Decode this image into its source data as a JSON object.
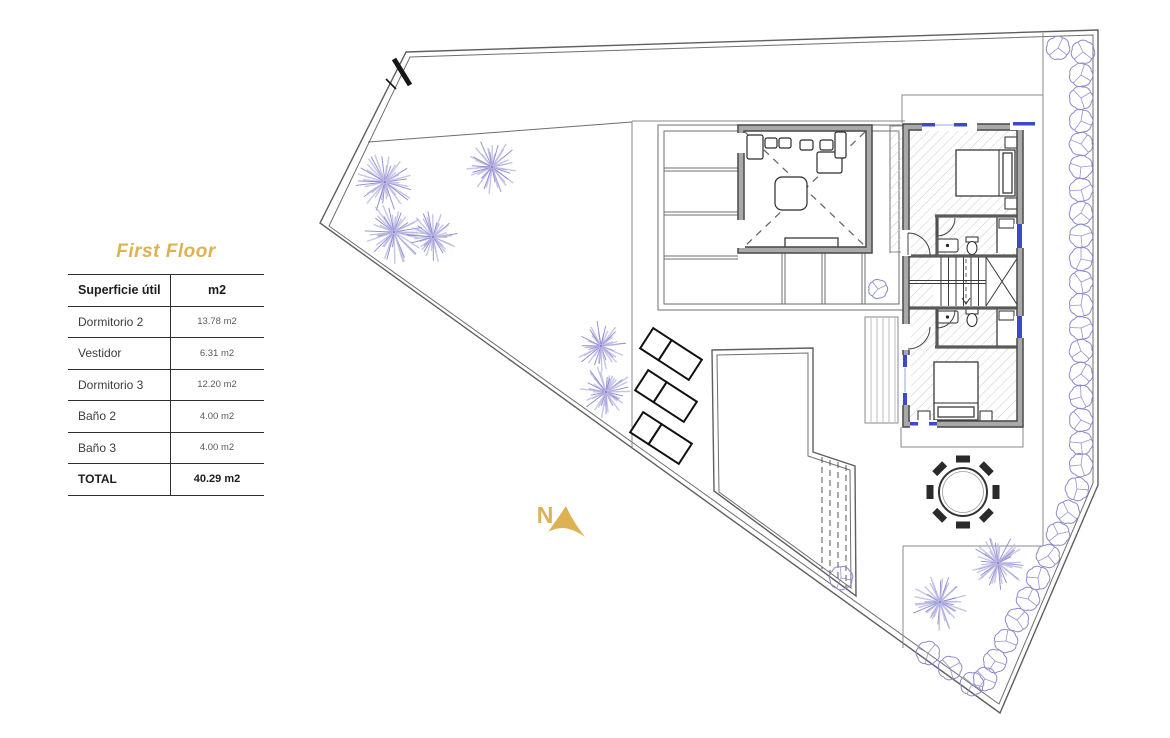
{
  "page_title": "First Floor",
  "area_table": {
    "header": {
      "label": "Superficie útil",
      "unit": "m2"
    },
    "rows": [
      {
        "label": "Dormitorio 2",
        "value": "13.78 m2"
      },
      {
        "label": "Vestidor",
        "value": "6.31 m2"
      },
      {
        "label": "Dormitorio 3",
        "value": "12.20 m2"
      },
      {
        "label": "Baño 2",
        "value": "4.00 m2"
      },
      {
        "label": "Baño 3",
        "value": "4.00 m2"
      }
    ],
    "total": {
      "label": "TOTAL",
      "value": "40.29 m2"
    }
  },
  "compass": {
    "label": "N"
  },
  "colors": {
    "accent_gold": "#DDB253",
    "plant_purple": "#8D89CD",
    "plant_purple_light": "#B9B6E4",
    "window_blue": "#3B4BC8",
    "wall_gray": "#A9A9A9"
  },
  "plan": {
    "trees": [
      {
        "x": 385,
        "y": 182,
        "r": 30
      },
      {
        "x": 394,
        "y": 232,
        "r": 33
      },
      {
        "x": 433,
        "y": 237,
        "r": 27
      },
      {
        "x": 492,
        "y": 167,
        "r": 28
      },
      {
        "x": 601,
        "y": 346,
        "r": 26
      },
      {
        "x": 606,
        "y": 392,
        "r": 27
      },
      {
        "x": 940,
        "y": 602,
        "r": 29
      },
      {
        "x": 998,
        "y": 563,
        "r": 29
      }
    ],
    "bushes": [
      {
        "x": 1058,
        "y": 48
      },
      {
        "x": 1083,
        "y": 52
      },
      {
        "x": 1081,
        "y": 75
      },
      {
        "x": 1081,
        "y": 98
      },
      {
        "x": 1081,
        "y": 121
      },
      {
        "x": 1081,
        "y": 144
      },
      {
        "x": 1081,
        "y": 167
      },
      {
        "x": 1081,
        "y": 190
      },
      {
        "x": 1081,
        "y": 213
      },
      {
        "x": 1081,
        "y": 236
      },
      {
        "x": 1081,
        "y": 259
      },
      {
        "x": 1081,
        "y": 282
      },
      {
        "x": 1081,
        "y": 305
      },
      {
        "x": 1081,
        "y": 328
      },
      {
        "x": 1081,
        "y": 351
      },
      {
        "x": 1081,
        "y": 374
      },
      {
        "x": 1081,
        "y": 397
      },
      {
        "x": 1081,
        "y": 420
      },
      {
        "x": 1081,
        "y": 443
      },
      {
        "x": 1081,
        "y": 465
      },
      {
        "x": 1077,
        "y": 489
      },
      {
        "x": 1068,
        "y": 512
      },
      {
        "x": 1058,
        "y": 534
      },
      {
        "x": 1048,
        "y": 556
      },
      {
        "x": 1038,
        "y": 578
      },
      {
        "x": 1028,
        "y": 599
      },
      {
        "x": 1017,
        "y": 620
      },
      {
        "x": 1006,
        "y": 641
      },
      {
        "x": 995,
        "y": 661
      },
      {
        "x": 985,
        "y": 679
      },
      {
        "x": 928,
        "y": 653
      },
      {
        "x": 950,
        "y": 668
      },
      {
        "x": 972,
        "y": 684
      },
      {
        "x": 878,
        "y": 289,
        "r": 9
      },
      {
        "x": 841,
        "y": 578,
        "r": 11
      }
    ],
    "dining_table": {
      "x": 963,
      "y": 492,
      "r": 24,
      "chairs": 8
    }
  }
}
